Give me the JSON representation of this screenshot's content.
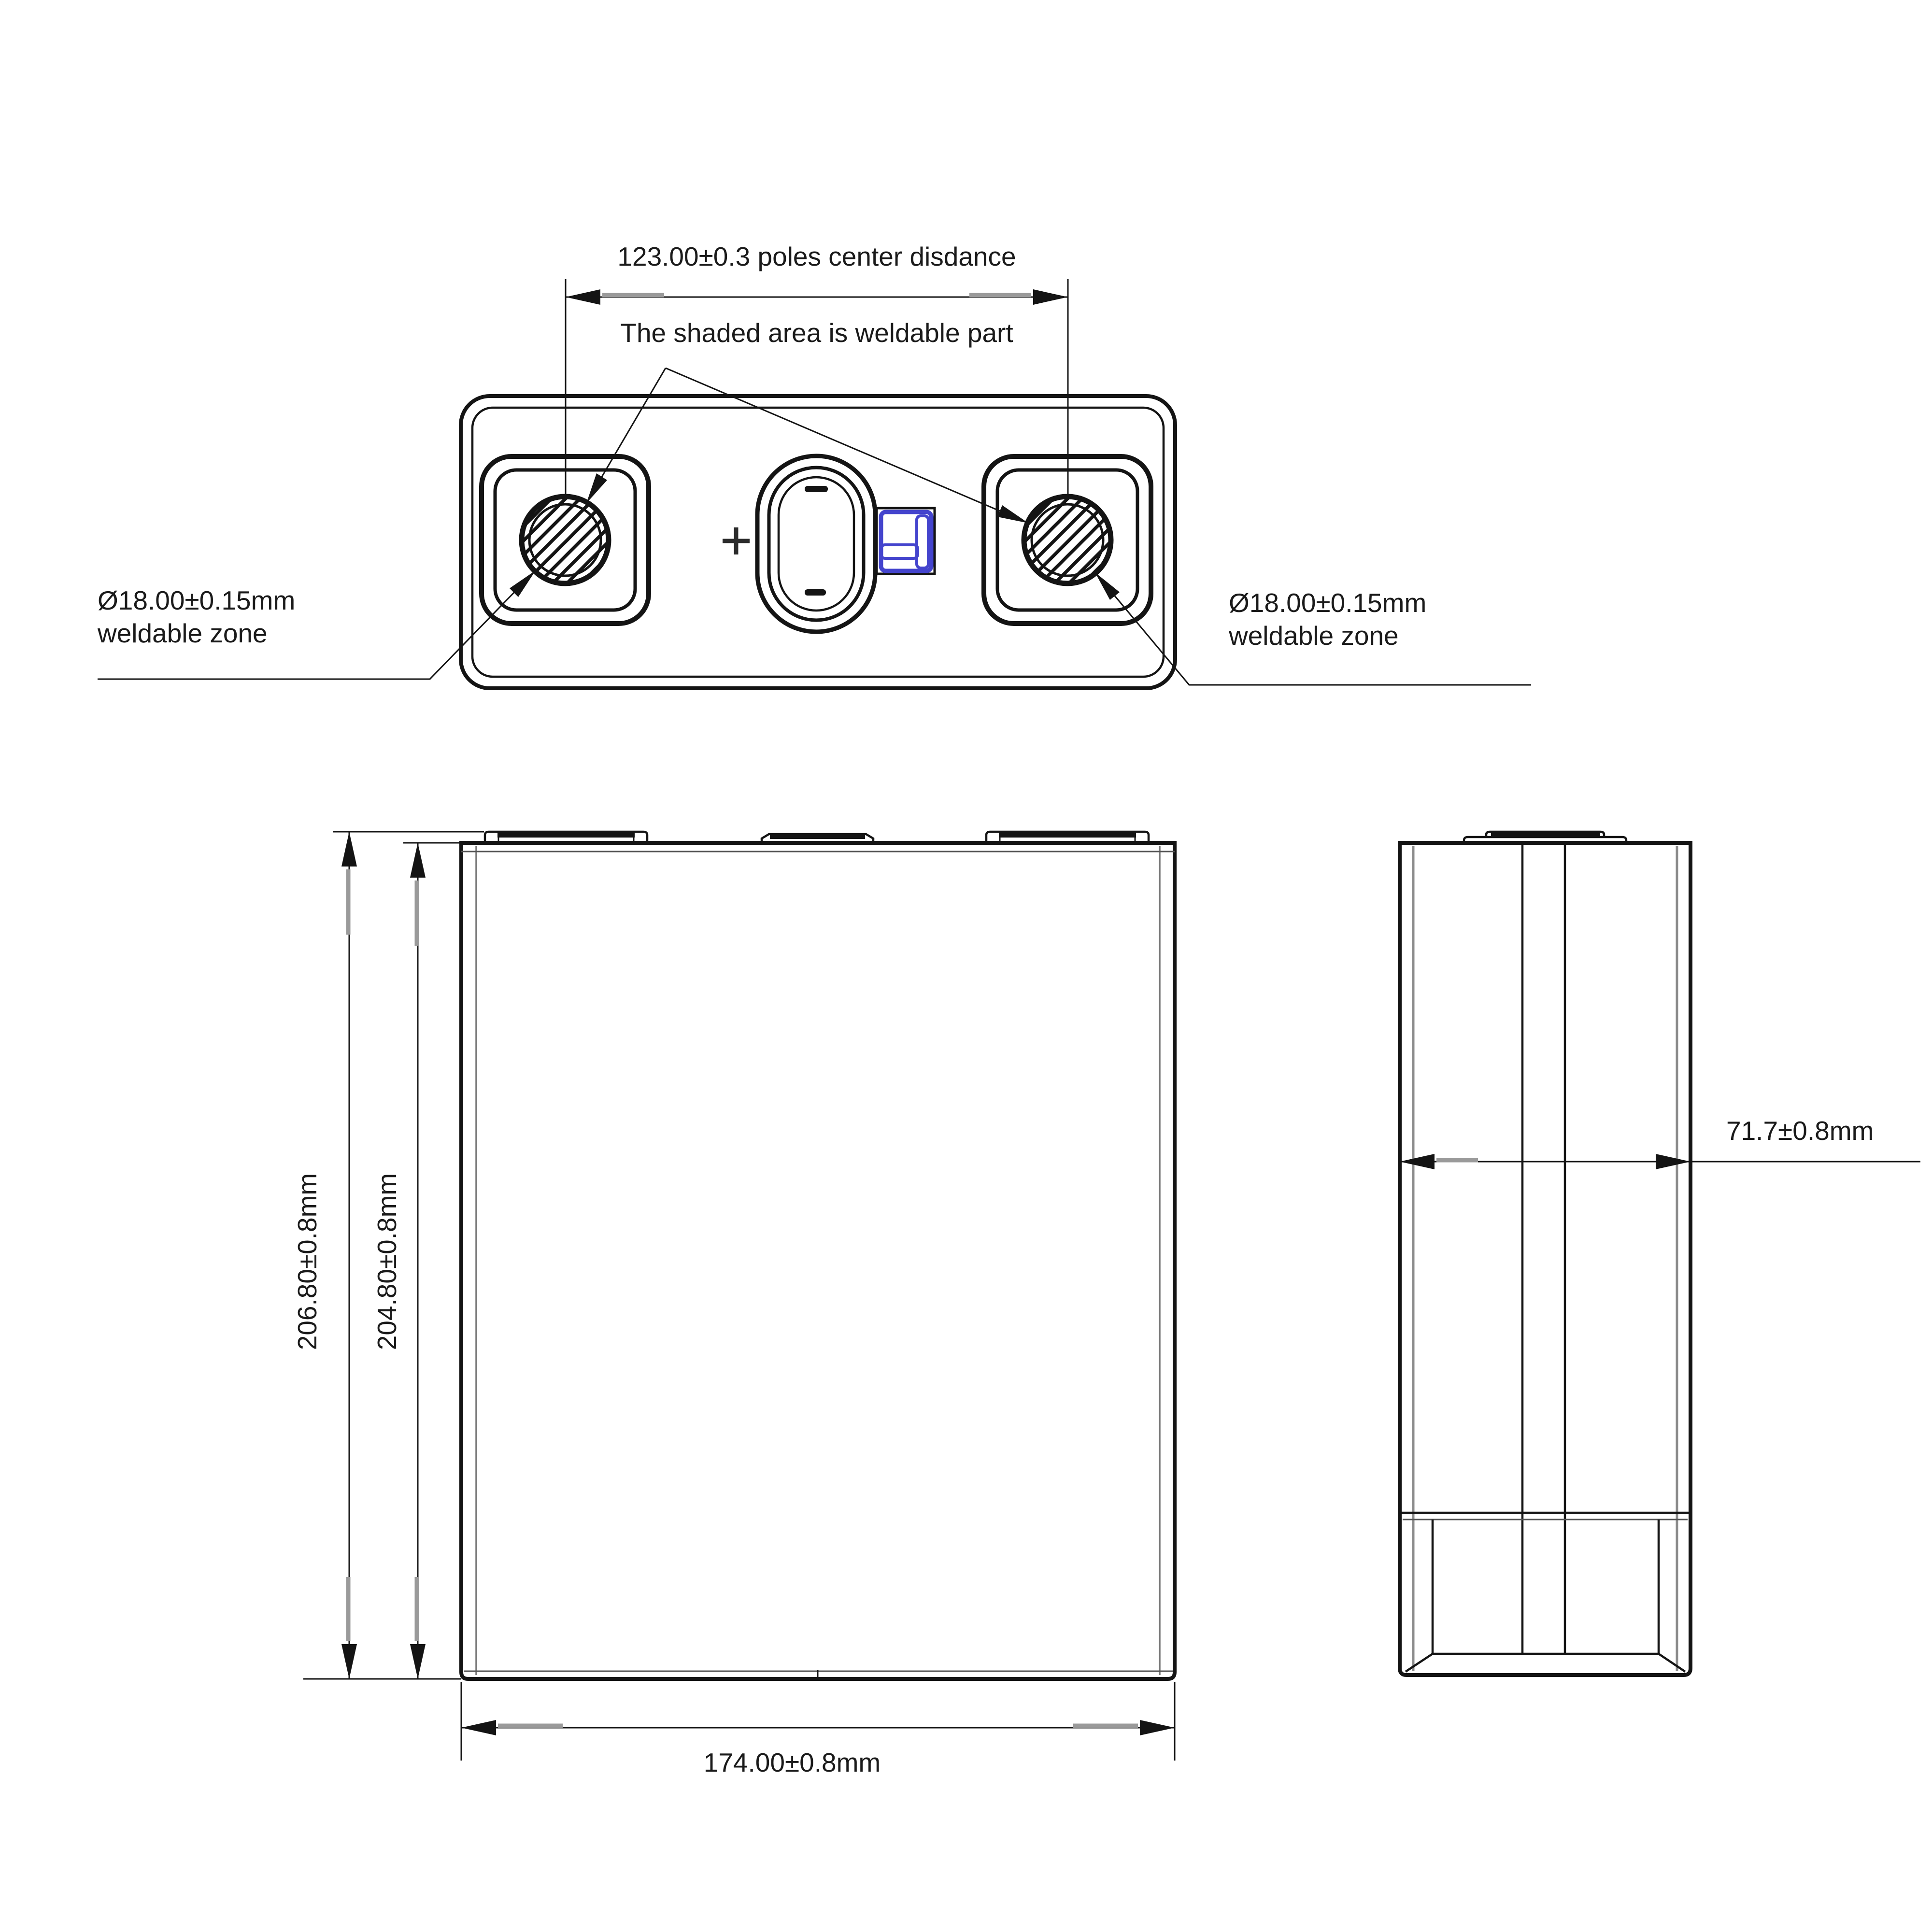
{
  "top_view": {
    "poles_dim_label": "123.00±0.3 poles center disdance",
    "weldable_note": "The shaded area is weldable part",
    "left_zone": {
      "line1": "Ø18.00±0.15mm",
      "line2": "weldable zone"
    },
    "right_zone": {
      "line1": "Ø18.00±0.15mm",
      "line2": "weldable zone"
    }
  },
  "front_view": {
    "overall_height": "206.80±0.8mm",
    "case_height": "204.80±0.8mm",
    "width": "174.00±0.8mm"
  },
  "side_view": {
    "thickness": "71.7±0.8mm"
  },
  "style": {
    "line_color": "#141414",
    "accent_blue": "#4444cd",
    "background": "#ffffff"
  }
}
